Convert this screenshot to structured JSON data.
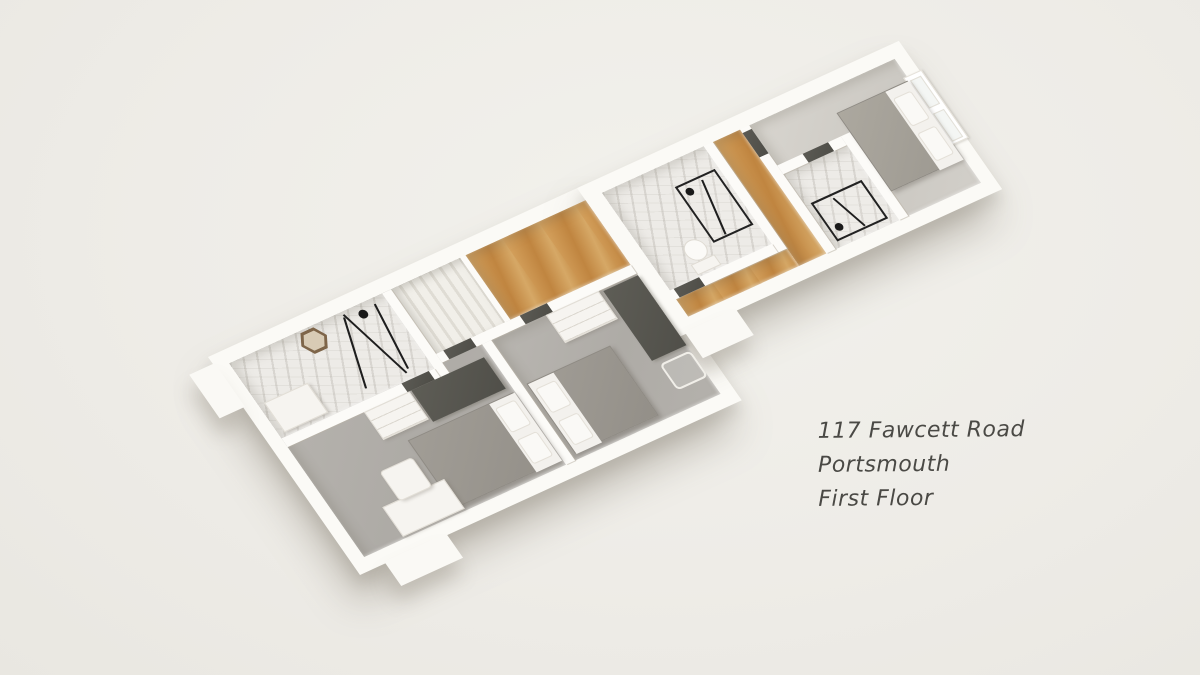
{
  "scene": {
    "type": "3d-floorplan-render",
    "background_color": "#eeece7",
    "shadow_color": "rgba(128,121,108,0.38)"
  },
  "caption": {
    "lines": {
      "line1": "117 Fawcett Road",
      "line2": "Portsmouth",
      "line3": "First Floor"
    },
    "text_color": "#4a4945"
  },
  "palette": {
    "wall_white": "#fcfbf8",
    "carpet_gray": "#b1aea9",
    "carpet_light_gray": "#d0cdc7",
    "wood_oak": "#c9904b",
    "marble_tile": "#edebe7",
    "door_panel": "#54534d",
    "wardrobe_dark": "#56554f",
    "bed_duvet_gray": "#9a968f",
    "linen_white": "#f5f3ef",
    "fixture_black": "#1e1e1e",
    "mirror_bronze": "#7e6549"
  },
  "floorplan": {
    "floor_label": "First Floor",
    "rooms": [
      {
        "id": "bedroom-1",
        "floor": "carpet",
        "furniture": [
          "double-bed",
          "desk",
          "chair",
          "wardrobe",
          "chest-of-drawers"
        ]
      },
      {
        "id": "shower-room-1",
        "floor": "marble",
        "furniture": [
          "shower-frame",
          "vanity-unit",
          "hexagon-mirror"
        ]
      },
      {
        "id": "bedroom-2",
        "floor": "carpet",
        "furniture": [
          "double-bed",
          "chest-of-drawers",
          "wardrobe",
          "wire-chair"
        ]
      },
      {
        "id": "landing-hall",
        "floor": "wood",
        "furniture": [
          "staircase"
        ]
      },
      {
        "id": "bathroom",
        "floor": "marble",
        "furniture": [
          "shower-enclosure",
          "toilet"
        ]
      },
      {
        "id": "corridor",
        "floor": "wood",
        "furniture": []
      },
      {
        "id": "shower-room-2",
        "floor": "marble",
        "furniture": [
          "shower-enclosure"
        ]
      },
      {
        "id": "bedroom-3",
        "floor": "carpet-light",
        "furniture": [
          "double-bed",
          "window"
        ]
      }
    ],
    "door_count": 5,
    "window_count": 1
  }
}
